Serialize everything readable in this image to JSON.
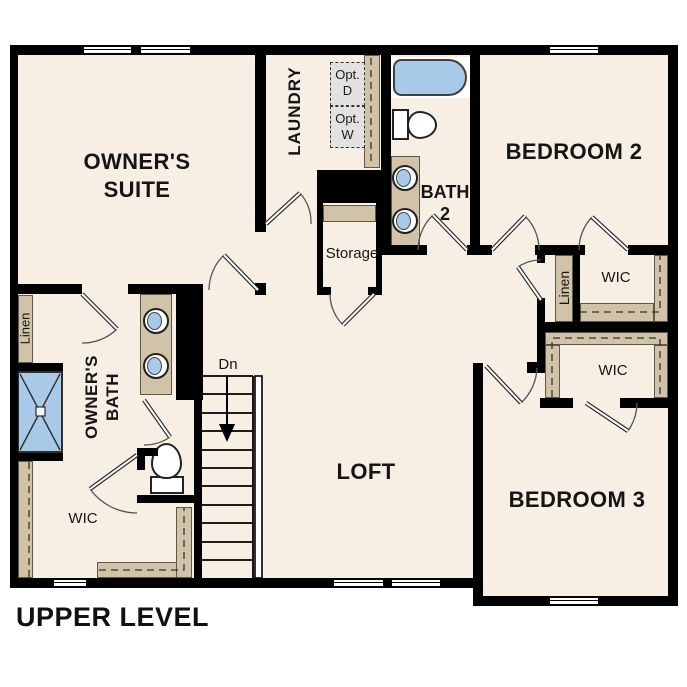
{
  "title": "UPPER LEVEL",
  "rooms": {
    "owners_suite": {
      "line1": "OWNER'S",
      "line2": "SUITE"
    },
    "laundry": {
      "label": "LAUNDRY"
    },
    "bedroom_2": {
      "label": "BEDROOM 2"
    },
    "bath_2": {
      "line1": "BATH",
      "line2": "2"
    },
    "storage": {
      "label": "Storage"
    },
    "loft": {
      "label": "LOFT"
    },
    "owners_bath": {
      "line1": "OWNER'S",
      "line2": "BATH"
    },
    "bedroom_3": {
      "label": "BEDROOM 3"
    },
    "wic_owner": {
      "label": "WIC"
    },
    "wic_bedroom_2": {
      "label": "WIC"
    },
    "wic_bedroom_3": {
      "label": "WIC"
    },
    "linen_left": {
      "label": "Linen"
    },
    "linen_right": {
      "label": "Linen"
    }
  },
  "annotations": {
    "stair_direction": "Dn",
    "optional_dryer": {
      "line1": "Opt.",
      "line2": "D"
    },
    "optional_washer": {
      "line1": "Opt.",
      "line2": "W"
    }
  },
  "colors": {
    "background": "#ffffff",
    "floor": "#f7efe4",
    "wall": "#000000",
    "casework": "#d0c3a8",
    "fixture_blue": "#a9c9e9",
    "optional_appliance_box": "#e2e2e2"
  }
}
